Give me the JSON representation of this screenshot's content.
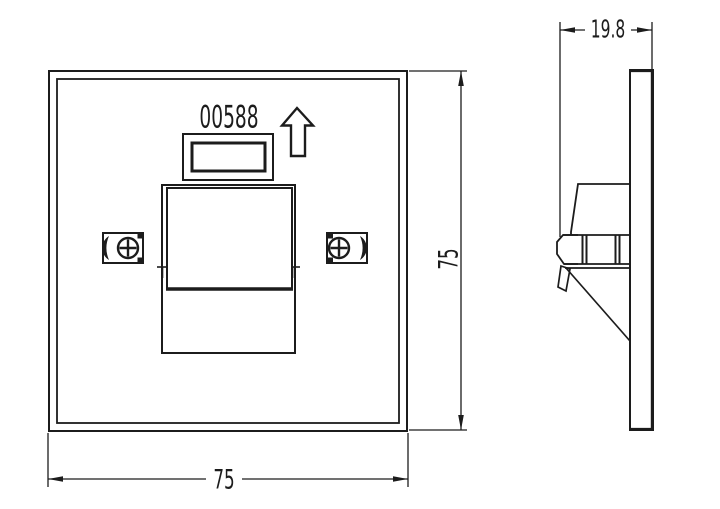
{
  "drawing": {
    "background_color": "#ffffff",
    "line_color": "#1c1c1c",
    "front_view": {
      "part_number": "00588",
      "width_label": "75",
      "height_label": "75",
      "orientation_icon": "up-arrow",
      "screw_icon": "phillips-screw"
    },
    "side_view": {
      "depth_label": "19.8"
    }
  }
}
